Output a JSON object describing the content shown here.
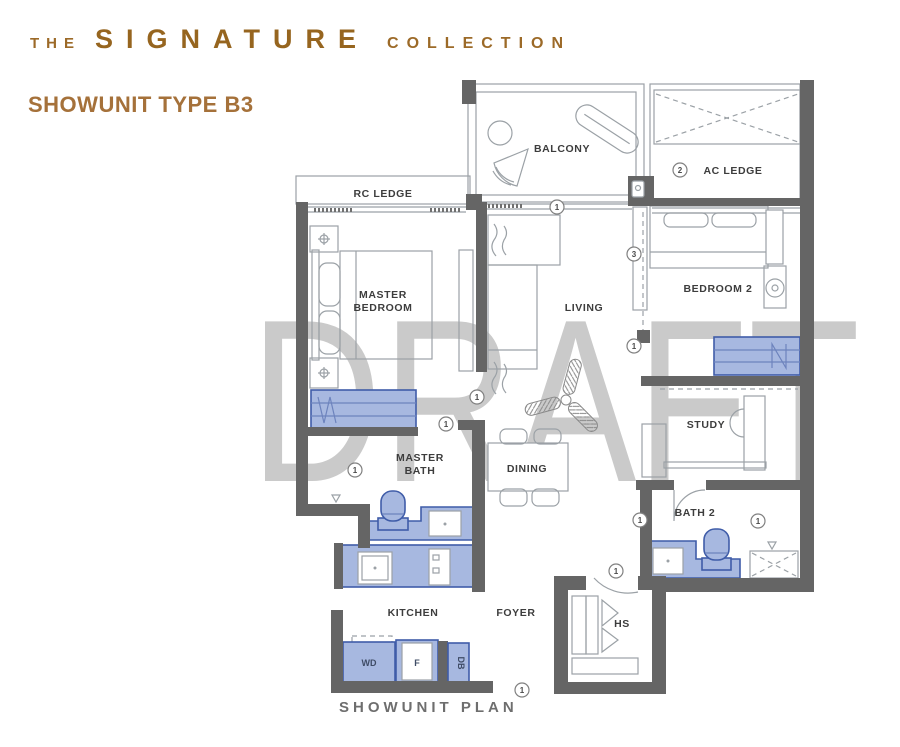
{
  "header": {
    "the": "THE",
    "signature": "SIGNATURE",
    "collection": "COLLECTION",
    "unit_title": "SHOWUNIT TYPE B3"
  },
  "watermark": "DRAFT",
  "plan_caption": "SHOWUNIT PLAN",
  "labels": {
    "rc_ledge": "RC LEDGE",
    "balcony": "BALCONY",
    "ac_ledge": "AC LEDGE",
    "master_bedroom_line1": "MASTER",
    "master_bedroom_line2": "BEDROOM",
    "living": "LIVING",
    "bedroom2": "BEDROOM 2",
    "study": "STUDY",
    "master_bath_line1": "MASTER",
    "master_bath_line2": "BATH",
    "dining": "DINING",
    "bath2": "BATH 2",
    "kitchen": "KITCHEN",
    "foyer": "FOYER",
    "hs": "HS"
  },
  "appliances": {
    "washer_dryer": "WD",
    "fridge": "F",
    "distribution_board": "DB"
  },
  "markers": {
    "one": "1",
    "two": "2",
    "three": "3"
  },
  "colors": {
    "brand_brown": "#9c6a28",
    "title_brown": "#a5713a",
    "wall_gray": "#656565",
    "fixture_fill": "#a7b8e0",
    "fixture_stroke": "#3f5ca8",
    "watermark_gray": "#cacaca",
    "label_gray": "#3d3d3d",
    "caption_gray": "#6e6e6e"
  }
}
